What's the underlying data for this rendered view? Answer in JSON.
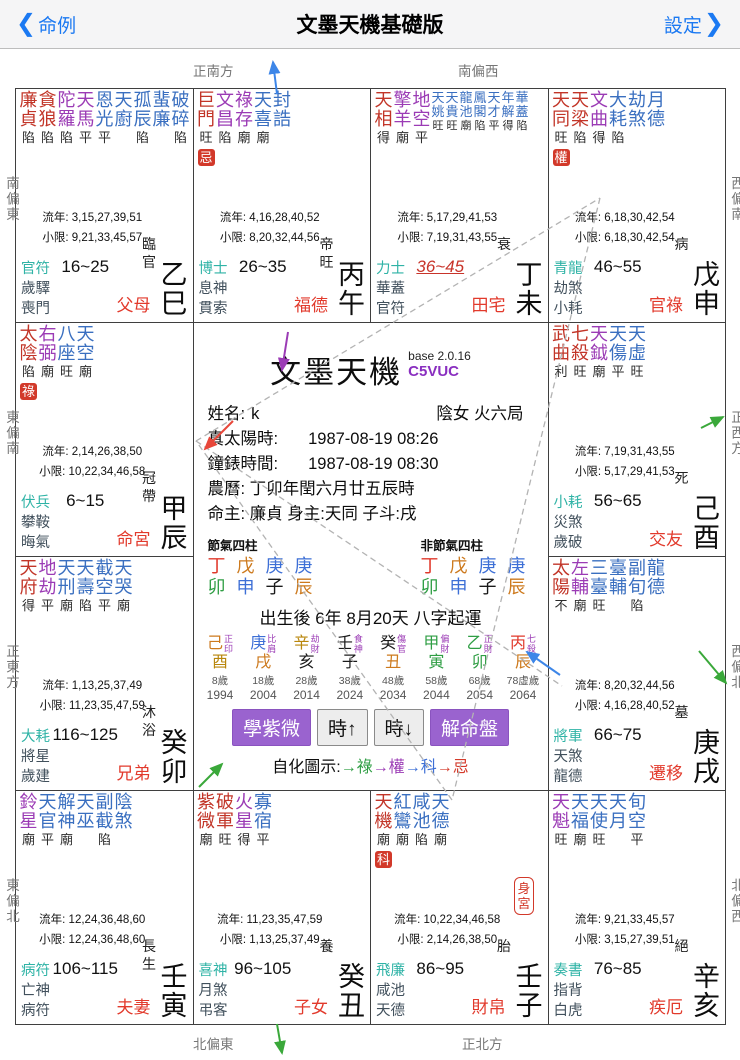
{
  "header": {
    "back_chevron": "❮",
    "back": "命例",
    "title": "文墨天機基礎版",
    "settings": "設定",
    "settings_chevron": "❯"
  },
  "compass": {
    "top": [
      "正南方",
      "南偏西"
    ],
    "bottom": [
      "北偏東",
      "正北方"
    ],
    "left": [
      "南偏東",
      "東偏南",
      "正東方",
      "東偏北"
    ],
    "right": [
      "西偏南",
      "正西方",
      "西偏北",
      "北偏西"
    ]
  },
  "labels": {
    "liunian": "流年:",
    "xiaoxian": "小限:",
    "body": "身宮"
  },
  "colors": {
    "accent_blue": "#1b79f2",
    "star_main": "#c23528",
    "star_aux": "#9b3bb5",
    "star_minor": "#3a6fc0",
    "god_first": "#2fb3a6",
    "god_rest": "#41505c",
    "palace_name": "#e23a2c",
    "badge_bg": "#d2392a",
    "highlight": "#c8342a",
    "btn_purple": "#9a63cf",
    "code_purple": "#8a2fc0",
    "chars": {
      "丁": "#e0392b",
      "丙": "#e0392b",
      "卯": "#2f9e44",
      "甲": "#2f9e44",
      "乙": "#2f9e44",
      "寅": "#2f9e44",
      "戊": "#cd7a1e",
      "己": "#cd7a1e",
      "辰": "#cd7a1e",
      "戌": "#cd7a1e",
      "丑": "#cd7a1e",
      "庚": "#3d6fd6",
      "申": "#3d6fd6",
      "辛": "#b8860b",
      "酉": "#b8860b",
      "壬": "#1a1a1a",
      "癸": "#1a1a1a",
      "子": "#1a1a1a",
      "亥": "#1a1a1a"
    }
  },
  "palaces": [
    {
      "gz": "乙巳",
      "stage": "臨官",
      "name": "父母",
      "badge": "",
      "body": false,
      "stars": [
        [
          "廉貞",
          "main",
          "陷"
        ],
        [
          "貪狼",
          "main",
          "陷"
        ],
        [
          "陀羅",
          "aux",
          "陷"
        ],
        [
          "天馬",
          "aux",
          "平"
        ],
        [
          "恩光",
          "minor",
          "平"
        ],
        [
          "天廚",
          "minor",
          ""
        ],
        [
          "孤辰",
          "minor",
          "陷"
        ],
        [
          "蜚廉",
          "minor",
          ""
        ],
        [
          "破碎",
          "minor",
          "陷"
        ]
      ],
      "liunian": "3,15,27,39,51",
      "xiaoxian": "9,21,33,45,57",
      "range": "16~25",
      "hl": false,
      "gods": [
        "官符",
        "歲驛",
        "喪門"
      ]
    },
    {
      "gz": "丙午",
      "stage": "帝旺",
      "name": "福德",
      "badge": "忌",
      "body": false,
      "stars": [
        [
          "巨門",
          "main",
          "旺"
        ],
        [
          "文昌",
          "aux",
          "陷"
        ],
        [
          "祿存",
          "aux",
          "廟"
        ],
        [
          "天喜",
          "minor",
          "廟"
        ],
        [
          "封誥",
          "minor",
          ""
        ]
      ],
      "liunian": "4,16,28,40,52",
      "xiaoxian": "8,20,32,44,56",
      "range": "26~35",
      "hl": false,
      "gods": [
        "博士",
        "息神",
        "貫索"
      ]
    },
    {
      "gz": "丁未",
      "stage": "衰",
      "name": "田宅",
      "badge": "",
      "body": false,
      "stars": [
        [
          "天相",
          "main",
          "得"
        ],
        [
          "擎羊",
          "aux",
          "廟"
        ],
        [
          "地空",
          "aux",
          "平"
        ],
        [
          "天姚",
          "small",
          "旺"
        ],
        [
          "天貴",
          "small",
          "旺"
        ],
        [
          "龍池",
          "small",
          "廟"
        ],
        [
          "鳳閣",
          "small",
          "陷"
        ],
        [
          "天才",
          "small",
          "平"
        ],
        [
          "年解",
          "small",
          "得"
        ],
        [
          "華蓋",
          "small",
          "陷"
        ]
      ],
      "liunian": "5,17,29,41,53",
      "xiaoxian": "7,19,31,43,55",
      "range": "36~45",
      "hl": true,
      "gods": [
        "力士",
        "華蓋",
        "官符"
      ]
    },
    {
      "gz": "戊申",
      "stage": "病",
      "name": "官祿",
      "badge": "權",
      "body": false,
      "stars": [
        [
          "天同",
          "main",
          "旺"
        ],
        [
          "天梁",
          "main",
          "陷"
        ],
        [
          "文曲",
          "aux",
          "得"
        ],
        [
          "大耗",
          "minor",
          "陷"
        ],
        [
          "劫煞",
          "minor",
          ""
        ],
        [
          "月德",
          "minor",
          ""
        ]
      ],
      "liunian": "6,18,30,42,54",
      "xiaoxian": "6,18,30,42,54",
      "range": "46~55",
      "hl": false,
      "gods": [
        "青龍",
        "劫煞",
        "小耗"
      ]
    },
    {
      "gz": "甲辰",
      "stage": "冠帶",
      "name": "命宮",
      "badge": "祿",
      "body": false,
      "stars": [
        [
          "太陰",
          "main",
          "陷"
        ],
        [
          "右弼",
          "aux",
          "廟"
        ],
        [
          "八座",
          "minor",
          "旺"
        ],
        [
          "天空",
          "minor",
          "廟"
        ]
      ],
      "liunian": "2,14,26,38,50",
      "xiaoxian": "10,22,34,46,58",
      "range": "6~15",
      "hl": false,
      "gods": [
        "伏兵",
        "攀鞍",
        "晦氣"
      ]
    },
    {
      "gz": "己酉",
      "stage": "死",
      "name": "交友",
      "badge": "",
      "body": false,
      "stars": [
        [
          "武曲",
          "main",
          "利"
        ],
        [
          "七殺",
          "main",
          "旺"
        ],
        [
          "天鉞",
          "aux",
          "廟"
        ],
        [
          "天傷",
          "minor",
          "平"
        ],
        [
          "天虛",
          "minor",
          "旺"
        ]
      ],
      "liunian": "7,19,31,43,55",
      "xiaoxian": "5,17,29,41,53",
      "range": "56~65",
      "hl": false,
      "gods": [
        "小耗",
        "災煞",
        "歲破"
      ]
    },
    {
      "gz": "癸卯",
      "stage": "沐浴",
      "name": "兄弟",
      "badge": "",
      "body": false,
      "stars": [
        [
          "天府",
          "main",
          "得"
        ],
        [
          "地劫",
          "aux",
          "平"
        ],
        [
          "天刑",
          "minor",
          "廟"
        ],
        [
          "天壽",
          "minor",
          "陷"
        ],
        [
          "截空",
          "minor",
          "平"
        ],
        [
          "天哭",
          "minor",
          "廟"
        ]
      ],
      "liunian": "1,13,25,37,49",
      "xiaoxian": "11,23,35,47,59",
      "range": "116~125",
      "hl": false,
      "gods": [
        "大耗",
        "將星",
        "歲建"
      ]
    },
    {
      "gz": "庚戌",
      "stage": "墓",
      "name": "遷移",
      "badge": "",
      "body": false,
      "stars": [
        [
          "太陽",
          "main",
          "不"
        ],
        [
          "左輔",
          "aux",
          "廟"
        ],
        [
          "三臺",
          "minor",
          "旺"
        ],
        [
          "臺輔",
          "minor",
          ""
        ],
        [
          "副旬",
          "minor",
          "陷"
        ],
        [
          "龍德",
          "minor",
          ""
        ]
      ],
      "liunian": "8,20,32,44,56",
      "xiaoxian": "4,16,28,40,52",
      "range": "66~75",
      "hl": false,
      "gods": [
        "將軍",
        "天煞",
        "龍德"
      ]
    },
    {
      "gz": "壬寅",
      "stage": "長生",
      "name": "夫妻",
      "badge": "",
      "body": false,
      "stars": [
        [
          "鈴星",
          "aux",
          "廟"
        ],
        [
          "天官",
          "minor",
          "平"
        ],
        [
          "解神",
          "minor",
          "廟"
        ],
        [
          "天巫",
          "minor",
          ""
        ],
        [
          "副截",
          "minor",
          "陷"
        ],
        [
          "陰煞",
          "minor",
          ""
        ]
      ],
      "liunian": "12,24,36,48,60",
      "xiaoxian": "12,24,36,48,60",
      "range": "106~115",
      "hl": false,
      "gods": [
        "病符",
        "亡神",
        "病符"
      ]
    },
    {
      "gz": "癸丑",
      "stage": "養",
      "name": "子女",
      "badge": "",
      "body": false,
      "stars": [
        [
          "紫微",
          "main",
          "廟"
        ],
        [
          "破軍",
          "main",
          "旺"
        ],
        [
          "火星",
          "aux",
          "得"
        ],
        [
          "寡宿",
          "minor",
          "平"
        ]
      ],
      "liunian": "11,23,35,47,59",
      "xiaoxian": "1,13,25,37,49",
      "range": "96~105",
      "hl": false,
      "gods": [
        "喜神",
        "月煞",
        "弔客"
      ]
    },
    {
      "gz": "壬子",
      "stage": "胎",
      "name": "財帛",
      "badge": "科",
      "body": true,
      "stars": [
        [
          "天機",
          "main",
          "廟"
        ],
        [
          "紅鸞",
          "minor",
          "廟"
        ],
        [
          "咸池",
          "minor",
          "陷"
        ],
        [
          "天德",
          "minor",
          "廟"
        ]
      ],
      "liunian": "10,22,34,46,58",
      "xiaoxian": "2,14,26,38,50",
      "range": "86~95",
      "hl": false,
      "gods": [
        "飛廉",
        "咸池",
        "天德"
      ]
    },
    {
      "gz": "辛亥",
      "stage": "絕",
      "name": "疾厄",
      "badge": "",
      "body": false,
      "stars": [
        [
          "天魁",
          "aux",
          "旺"
        ],
        [
          "天福",
          "minor",
          "廟"
        ],
        [
          "天使",
          "minor",
          "旺"
        ],
        [
          "天月",
          "minor",
          ""
        ],
        [
          "旬空",
          "minor",
          "平"
        ]
      ],
      "liunian": "9,21,33,45,57",
      "xiaoxian": "3,15,27,39,51",
      "range": "76~85",
      "hl": false,
      "gods": [
        "奏書",
        "指背",
        "白虎"
      ]
    }
  ],
  "center": {
    "title": "文墨天機",
    "version": "base 2.0.16",
    "code": "C5VUC",
    "name_label": "姓名:",
    "name_value": "k",
    "gender_bureau": "陰女 火六局",
    "true_solar_label": "真太陽時:",
    "true_solar_value": "1987-08-19  08:26",
    "clock_label": "鐘錶時間:",
    "clock_value": "1987-08-19  08:30",
    "lunar_line": "農曆: 丁卯年閏六月廿五辰時",
    "masters_line": "命主: 廉貞 身主:天同  子斗:戌",
    "four_pillars": {
      "jieqi_label": "節氣四柱",
      "other_label": "非節氣四柱",
      "pillars": [
        [
          "丁",
          "卯"
        ],
        [
          "戊",
          "申"
        ],
        [
          "庚",
          "子"
        ],
        [
          "庚",
          "辰"
        ]
      ]
    },
    "start_line": "出生後 6年 8月20天 八字起運",
    "luck": [
      {
        "stem": "己",
        "branch": "酉",
        "god": "正印",
        "age": "8歲",
        "year": "1994"
      },
      {
        "stem": "庚",
        "branch": "戌",
        "god": "比肩",
        "age": "18歲",
        "year": "2004"
      },
      {
        "stem": "辛",
        "branch": "亥",
        "god": "劫財",
        "age": "28歲",
        "year": "2014"
      },
      {
        "stem": "壬",
        "branch": "子",
        "god": "食神",
        "age": "38歲",
        "year": "2024"
      },
      {
        "stem": "癸",
        "branch": "丑",
        "god": "傷官",
        "age": "48歲",
        "year": "2034"
      },
      {
        "stem": "甲",
        "branch": "寅",
        "god": "偏財",
        "age": "58歲",
        "year": "2044"
      },
      {
        "stem": "乙",
        "branch": "卯",
        "god": "正財",
        "age": "68歲",
        "year": "2054"
      },
      {
        "stem": "丙",
        "branch": "辰",
        "god": "七殺",
        "age": "78虛歲",
        "year": "2064"
      }
    ],
    "buttons": [
      {
        "label": "學紫微",
        "style": "purple"
      },
      {
        "label": "時↑",
        "style": "gray"
      },
      {
        "label": "時↓",
        "style": "gray"
      },
      {
        "label": "解命盤",
        "style": "purple"
      }
    ],
    "legend_label": "自化圖示:",
    "legend": [
      {
        "arrow": "→",
        "char": "祿",
        "color": "#2f9e44"
      },
      {
        "arrow": "→",
        "char": "權",
        "color": "#9b3bb5"
      },
      {
        "arrow": "→",
        "char": "科",
        "color": "#3d6fd6"
      },
      {
        "arrow": "→",
        "char": "忌",
        "color": "#d43a2a"
      }
    ]
  }
}
